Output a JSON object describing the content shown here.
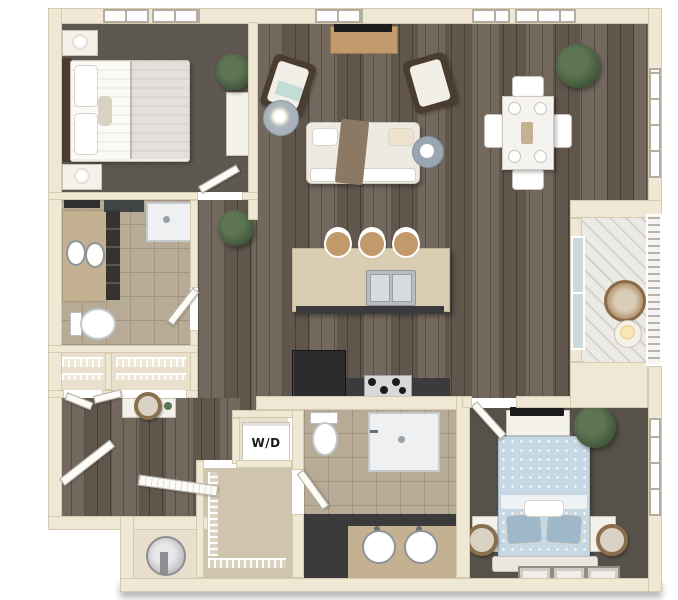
{
  "kind": "3d-apartment-floor-plan-render",
  "labels": {
    "washer_dryer": "W/D"
  },
  "palette": {
    "wall": "#efe8d5",
    "wallEdge": "#d5cab0",
    "wood": "#6b6055",
    "carpet1": "#5d5750",
    "carpet2": "#565149",
    "tile": "#b7aa96",
    "grout": "#a2957f",
    "tileLight": "#cfc4ad",
    "closet": "#e8e0cc",
    "deck": "#eceae4",
    "deckLine": "#d6d3cc",
    "rail": "#f5f4f0",
    "railLine": "#b7b3aa",
    "counter": "#3b3b3d",
    "island": "#d9cdb1",
    "islandEdge": "#c3b593",
    "tan": "#c4b192",
    "appliance": "#2c2c2e",
    "steel": "#b9bdc2",
    "steelDark": "#8f9499",
    "white": "#ffffff",
    "soft": "#f4f1ea",
    "softEdge": "#c9c3b6",
    "furnwood": "#c19a6c",
    "darkwood": "#4a3c2f",
    "sofa": "#edeae2",
    "throw": "#8c7964",
    "teal": "#c2dcd6",
    "bluebed": "#c6d8e4",
    "blueDeep": "#9fb8c9",
    "plant": "#5d7553",
    "plantDark": "#3e5538",
    "glass": "#ccd9dc",
    "door": "#fcfbf7",
    "frame": "#b3ada0",
    "black": "#1b1b1d",
    "mirror": "#8a6f4e"
  },
  "rooms": [
    {
      "id": "bedroom-1",
      "furniture": [
        "queen-bed",
        "nightstand-with-lamp",
        "nightstand-with-lamp",
        "wall-art-panels",
        "dresser",
        "potted-plant"
      ]
    },
    {
      "id": "bathroom-1",
      "furniture": [
        "double-sink-vanity",
        "toilet",
        "walk-in-shower",
        "dark-ledge"
      ]
    },
    {
      "id": "living-room",
      "furniture": [
        "tv",
        "media-console",
        "accent-chair",
        "accent-chair",
        "side-table-with-lamp",
        "sofa-with-throw",
        "round-side-table",
        "floor-plant"
      ]
    },
    {
      "id": "dining-area",
      "furniture": [
        "dining-table",
        "dining-chairs-x4",
        "place-settings",
        "potted-palm"
      ]
    },
    {
      "id": "kitchen",
      "furniture": [
        "island-with-double-sink",
        "bar-stools-x3",
        "refrigerator",
        "range",
        "counter"
      ]
    },
    {
      "id": "balcony",
      "furniture": [
        "round-chair",
        "side-table-with-lamp",
        "railing",
        "sliding-glass-door"
      ]
    },
    {
      "id": "entry",
      "furniture": [
        "front-door",
        "bifold-closet-doors",
        "console-table",
        "round-mirror"
      ]
    },
    {
      "id": "hall-closets",
      "furniture": [
        "wire-shelving",
        "wire-shelving"
      ]
    },
    {
      "id": "laundry-closet",
      "furniture": [
        "stacked-washer-dryer"
      ]
    },
    {
      "id": "walk-in-closet",
      "furniture": [
        "wire-shelving"
      ]
    },
    {
      "id": "utility-closet",
      "furniture": [
        "water-heater",
        "louver-door"
      ]
    },
    {
      "id": "bathroom-2",
      "furniture": [
        "double-round-sink-vanity",
        "dark-cabinet",
        "toilet",
        "shower"
      ]
    },
    {
      "id": "bedroom-2",
      "furniture": [
        "queen-bed-blue-floral",
        "nightstand",
        "nightstand",
        "leaning-round-mirror",
        "leaning-round-mirror",
        "dresser-with-tv",
        "potted-palm",
        "picture-frames-x3"
      ]
    }
  ]
}
